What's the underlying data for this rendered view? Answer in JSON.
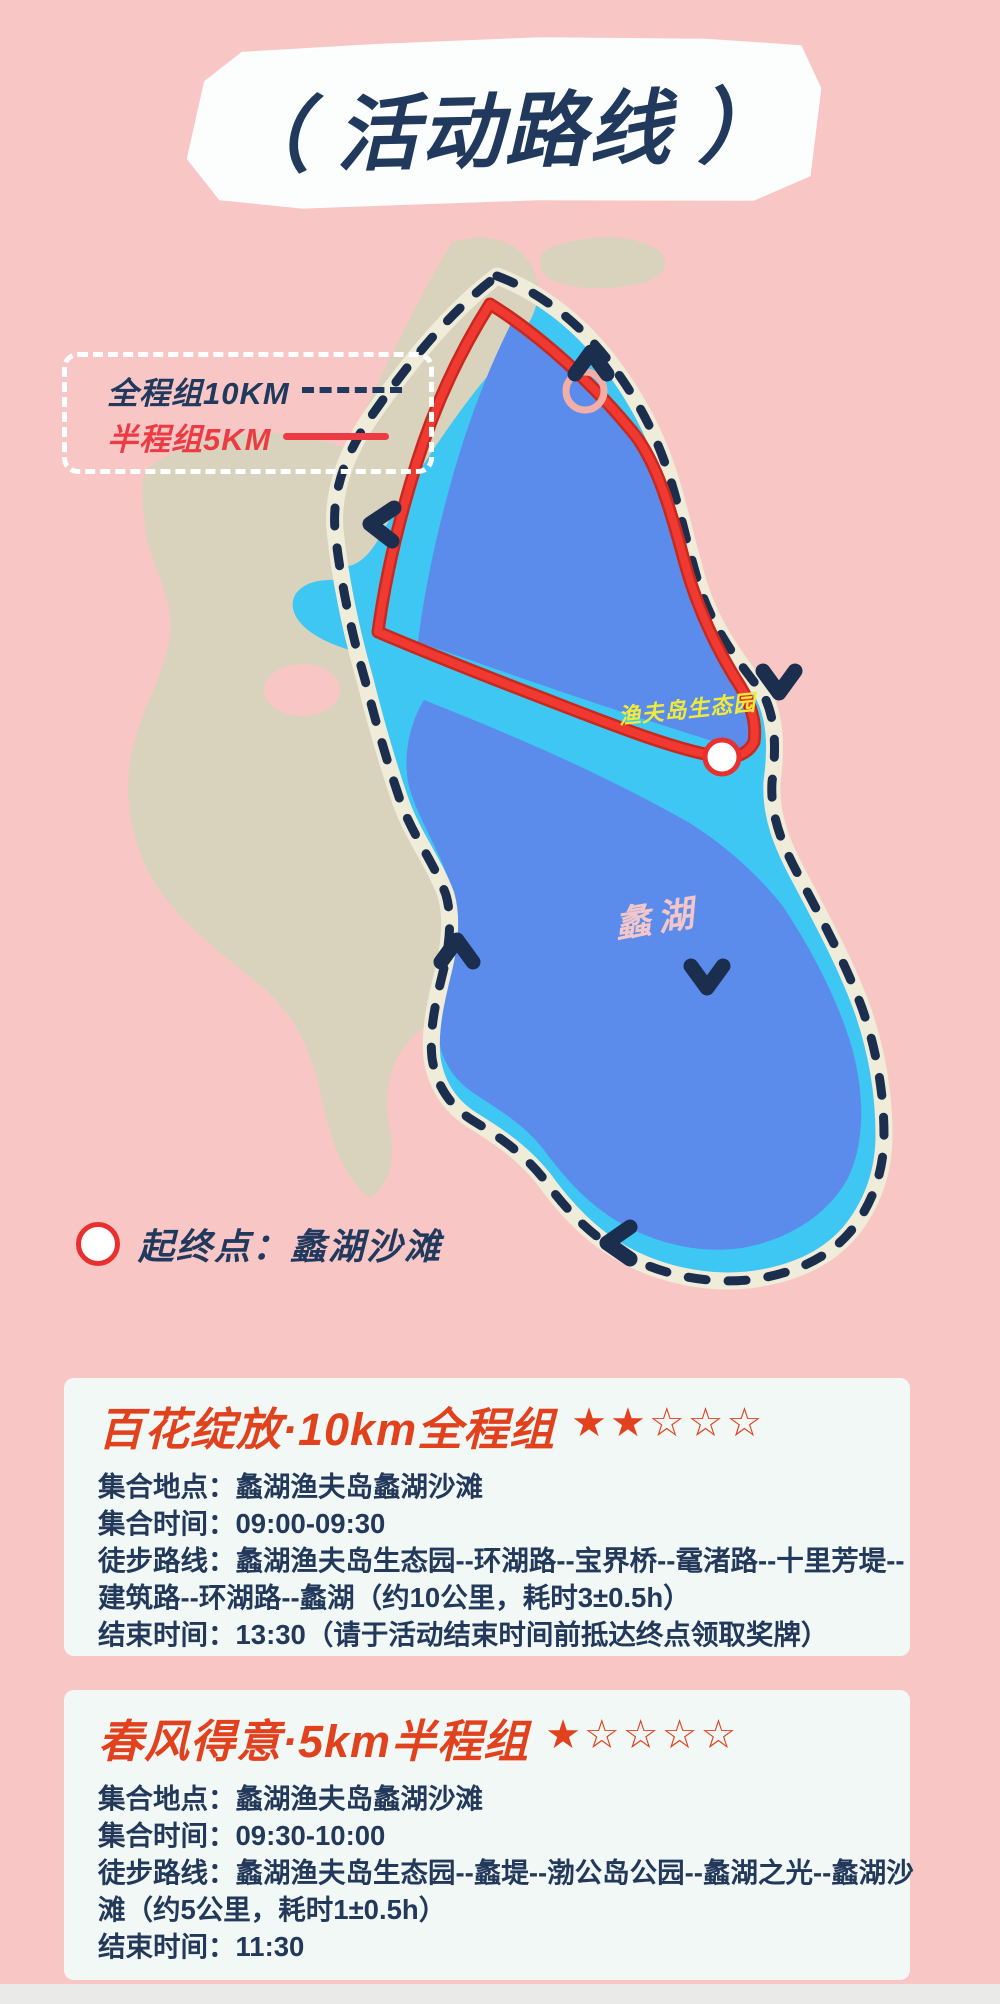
{
  "title": {
    "text": "（ 活动路线 ）"
  },
  "legend": {
    "full_label": "全程组10KM",
    "half_label": "半程组5KM"
  },
  "map": {
    "poi_label": "渔夫岛生态园",
    "lake_label": "蠡湖"
  },
  "start_legend": {
    "label": "起终点：蠡湖沙滩"
  },
  "cards": [
    {
      "title": "百花绽放·10km全程组",
      "stars_filled": "★★",
      "stars_empty": "☆☆☆",
      "lines": [
        "集合地点：蠡湖渔夫岛蠡湖沙滩",
        "集合时间：09:00-09:30",
        "徒步路线：蠡湖渔夫岛生态园--环湖路--宝界桥--鼋渚路--十里芳堤--",
        "建筑路--环湖路--蠡湖（约10公里，耗时3±0.5h）",
        "结束时间：13:30（请于活动结束时间前抵达终点领取奖牌）"
      ]
    },
    {
      "title": "春风得意·5km半程组",
      "stars_filled": "★",
      "stars_empty": "☆☆☆☆",
      "lines": [
        "集合地点：蠡湖渔夫岛蠡湖沙滩",
        "集合时间：09:30-10:00",
        "徒步路线：蠡湖渔夫岛生态园--蠡堤--渤公岛公园--蠡湖之光--蠡湖沙",
        "滩（约5公里，耗时1±0.5h）",
        "结束时间：11:30"
      ]
    }
  ],
  "colors": {
    "background_pink": "#F8C7C5",
    "navy": "#20395C",
    "route_red": "#ED3B43",
    "card_title_red": "#E2411E",
    "lake_shallow_cyan": "#3EC7F2",
    "lake_deep_blue": "#5B8CEC",
    "land_beige": "#D9D2BC",
    "route_casing_cream": "#EFECDA",
    "poi_yellow": "#F0EA3A",
    "lake_label_pink": "#F3C7C9",
    "card_background": "#F2F8F5"
  }
}
